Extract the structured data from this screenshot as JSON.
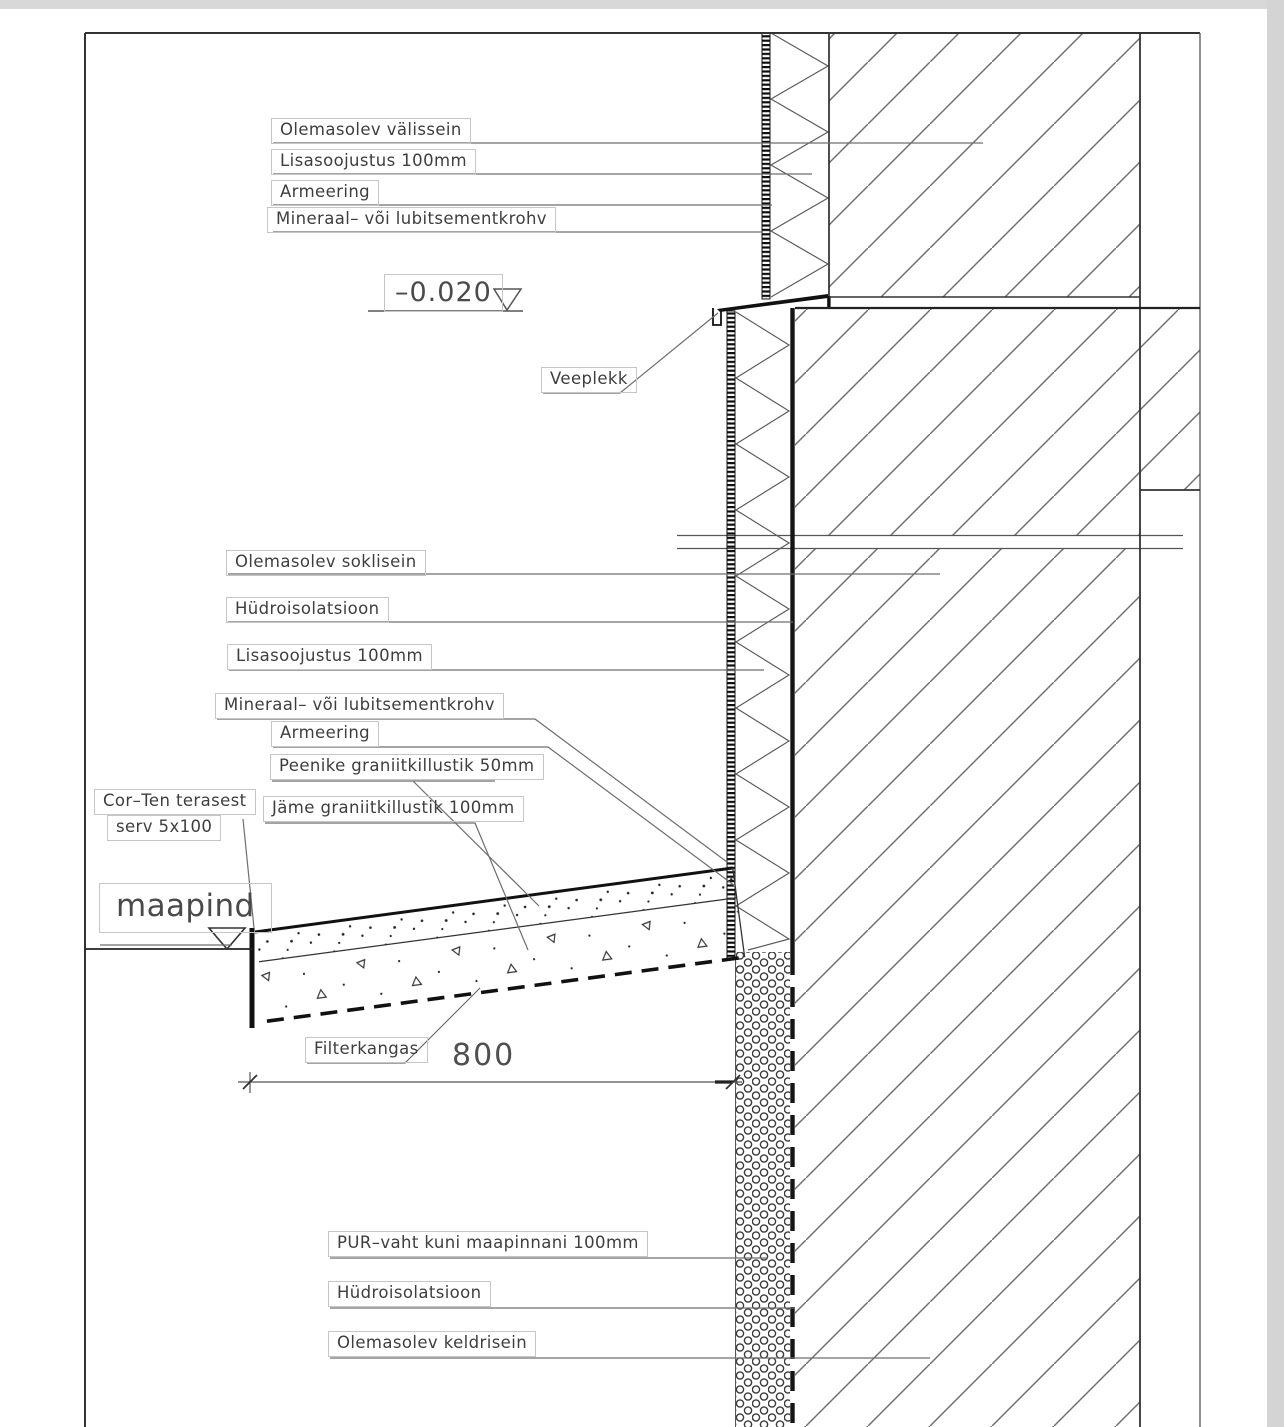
{
  "annotations": {
    "wall_upper": {
      "existing_wall": "Olemasolev välissein",
      "insulation": "Lisasoojustus 100mm",
      "reinforcement": "Armeering",
      "plaster": "Mineraal– või lubitsementkrohv"
    },
    "level_mark": "–0.020",
    "flashing": "Veeplekk",
    "plinth": {
      "existing_plinth": "Olemasolev soklisein",
      "waterproofing": "Hüdroisolatsioon",
      "insulation": "Lisasoojustus 100mm",
      "plaster": "Mineraal– või lubitsementkrohv",
      "reinforcement": "Armeering"
    },
    "ground": {
      "fine_gravel": "Peenike graniitkillustik 50mm",
      "coarse_gravel": "Jäme graniitkillustik 100mm",
      "corten_edge_line1": "Cor–Ten terasest",
      "corten_edge_line2": "serv 5x100",
      "ground_level": "maapind",
      "filter_fabric": "Filterkangas",
      "width_dimension": "800"
    },
    "basement": {
      "pur_foam": "PUR–vaht kuni maapinnani 100mm",
      "waterproofing": "Hüdroisolatsioon",
      "existing_wall": "Olemasolev keldrisein"
    }
  },
  "colors": {
    "line": "#222222",
    "hatch": "#6f6f6f",
    "leader": "#6e6e6e",
    "label_border": "#c6c6c6",
    "background": "#ffffff",
    "scan_edge": "#d8d8d8"
  }
}
